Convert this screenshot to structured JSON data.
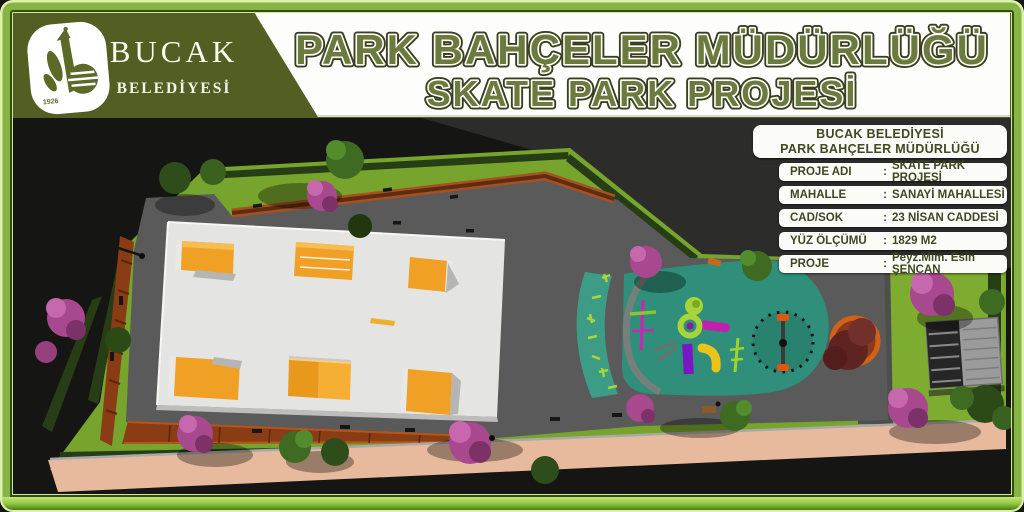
{
  "header": {
    "logo_year": "1926",
    "municipality_name": "BUCAK",
    "municipality_subtitle": "BELEDİYESİ",
    "title_line1": "PARK BAHÇELER MÜDÜRLÜĞÜ",
    "title_line2": "SKATE PARK PROJESİ"
  },
  "info_panel": {
    "header_line1": "BUCAK BELEDİYESİ",
    "header_line2": "PARK BAHÇELER MÜDÜRLÜĞÜ",
    "separator": ":",
    "rows": [
      {
        "label": "PROJE ADI",
        "value": "SKATE PARK PROJESİ"
      },
      {
        "label": "MAHALLE",
        "value": "SANAYİ MAHALLESİ"
      },
      {
        "label": "CAD/SOK",
        "value": "23 NİSAN CADDESİ"
      },
      {
        "label": "YÜZ ÖLÇÜMÜ",
        "value": "1829 M2"
      },
      {
        "label": "PROJE",
        "value": "Peyz.Mim. Esin ŞENCAN"
      }
    ]
  },
  "colors": {
    "frame_green": "#86b545",
    "frame_light": "#d3e896",
    "header_olive": "#535e22",
    "title_green": "#6b7a3d",
    "panel_text": "#3e4722",
    "ramp_orange": "#f0a125",
    "playground_teal": "#2f8f7a",
    "lawn_green": "#76a42c",
    "asphalt_gray": "#5a5a5a",
    "concrete_white": "#e4e4e2",
    "sidewalk_pink": "#e8ba9d",
    "walkway_brown": "#8a3c14"
  }
}
